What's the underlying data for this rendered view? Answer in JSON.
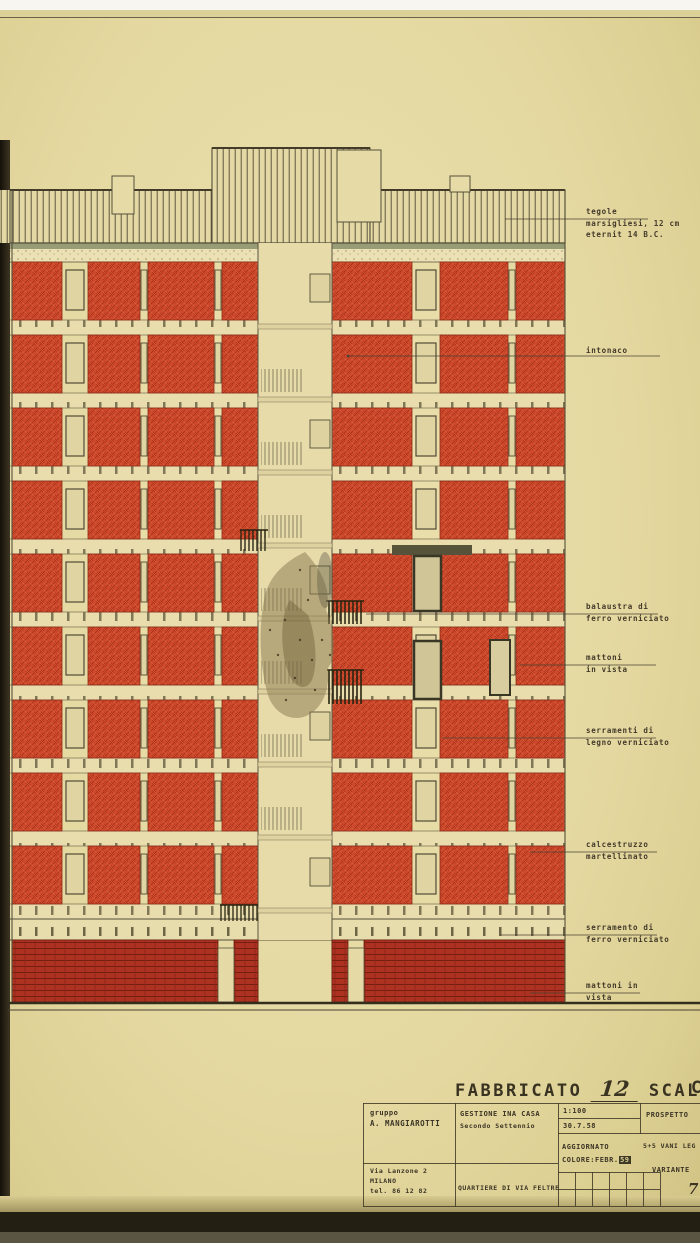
{
  "annotations": {
    "items": [
      {
        "lines": [
          "tegole",
          "marsigliesi, 12 cm",
          "eternit 14 B.C."
        ]
      },
      {
        "lines": [
          "intonaco"
        ]
      },
      {
        "lines": [
          "balaustra di",
          "ferro verniciato"
        ]
      },
      {
        "lines": [
          "mattoni",
          "in vista"
        ]
      },
      {
        "lines": [
          "serramenti di",
          "legno verniciato"
        ]
      },
      {
        "lines": [
          "calcestruzzo",
          "martellinato"
        ]
      },
      {
        "lines": [
          "serramento di",
          "ferro verniciato"
        ]
      },
      {
        "lines": [
          "mattoni in",
          "vista"
        ]
      }
    ]
  },
  "title": {
    "word1": "FABBRICATO",
    "number": "12",
    "word2": "SCALA",
    "suffix": "C"
  },
  "titleblock": {
    "studio_label": "gruppo",
    "studio_name": "A. MANGIAROTTI",
    "project": "GESTIONE INA CASA",
    "project_sub": "Secondo Settennio",
    "scale": "1:100",
    "date": "30.7.58",
    "sheet": "PROSPETTO",
    "updated_label": "AGGIORNATO",
    "updated_value": "COLORE:FEBR.",
    "updated_year": "59",
    "program": "5+5 VANI LEG",
    "variant_label": "VARIANTE",
    "variant_mark": "7",
    "address_line1": "Via Lanzone 2",
    "address_line2": "MILANO",
    "address_line3": "tel. 86 12 82",
    "district": "QUARTIERE DI VIA FELTRE"
  },
  "colors": {
    "paper": "#e7dcab",
    "red_panel": "#cf4a2c",
    "brick_base": "#ad3221",
    "ink": "#4a4232",
    "dark_edge": "#221e12"
  }
}
